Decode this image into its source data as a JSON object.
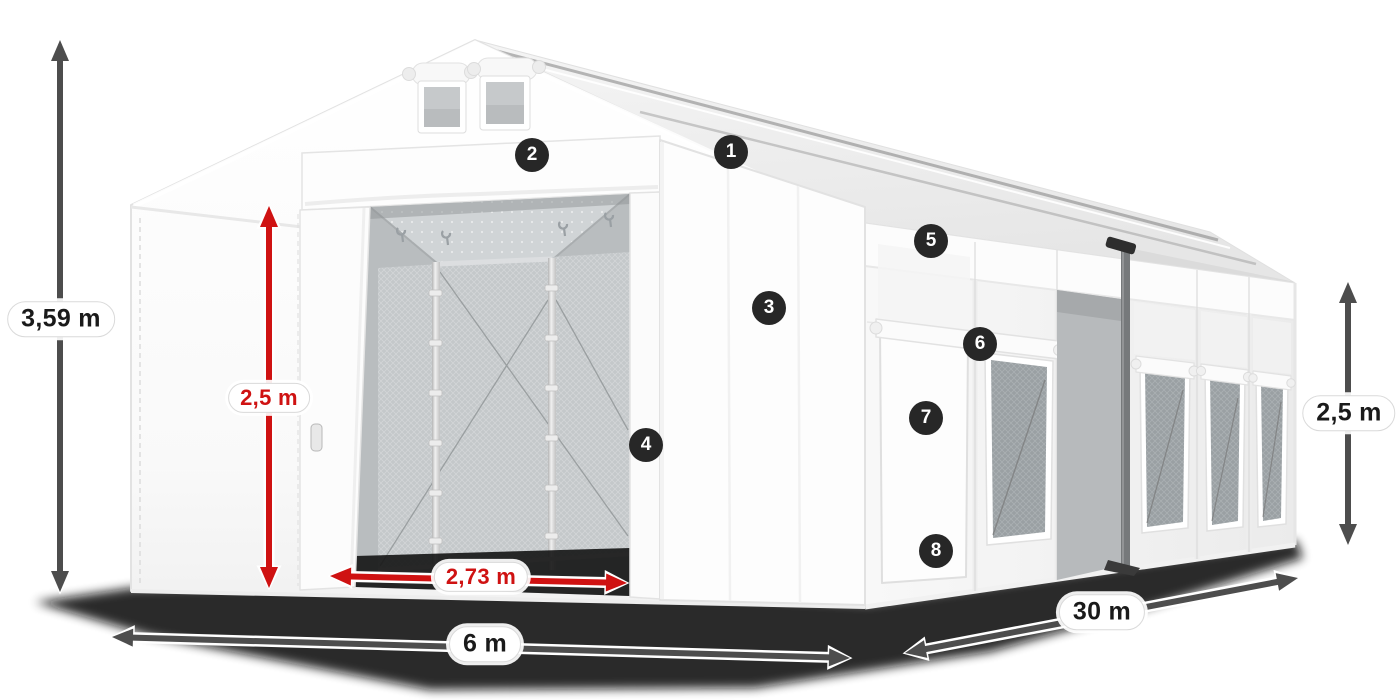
{
  "diagram": {
    "kind": "tent-dimension-diagram",
    "colors": {
      "background": "#ffffff",
      "red": "#cf1212",
      "dark": "#4d4d4d",
      "badge_bg": "#272727",
      "badge_text": "#ffffff",
      "label_text": "#1a1a1a"
    },
    "callouts": [
      {
        "label": "1",
        "x": 731,
        "y": 152
      },
      {
        "label": "2",
        "x": 532,
        "y": 155
      },
      {
        "label": "3",
        "x": 769,
        "y": 308
      },
      {
        "label": "4",
        "x": 646,
        "y": 445
      },
      {
        "label": "5",
        "x": 931,
        "y": 241
      },
      {
        "label": "6",
        "x": 980,
        "y": 344
      },
      {
        "label": "7",
        "x": 926,
        "y": 418
      },
      {
        "label": "8",
        "x": 936,
        "y": 551
      }
    ],
    "dimensions": [
      {
        "name": "total-height",
        "text": "3,59 m",
        "style": "dark",
        "x1": 60,
        "y1": 40,
        "x2": 60,
        "y2": 592,
        "label_x": 61,
        "label_y": 319
      },
      {
        "name": "entrance-height",
        "text": "2,5 m",
        "style": "red",
        "x1": 269,
        "y1": 206,
        "x2": 269,
        "y2": 588,
        "label_x": 269,
        "label_y": 398
      },
      {
        "name": "entrance-width",
        "text": "2,73 m",
        "style": "red",
        "x1": 330,
        "y1": 576,
        "x2": 627,
        "y2": 583,
        "label_x": 481,
        "label_y": 577
      },
      {
        "name": "front-width",
        "text": "6 m",
        "style": "dark",
        "x1": 112,
        "y1": 637,
        "x2": 850,
        "y2": 658,
        "label_x": 485,
        "label_y": 644
      },
      {
        "name": "side-length",
        "text": "30 m",
        "style": "dark",
        "x1": 905,
        "y1": 653,
        "x2": 1298,
        "y2": 578,
        "label_x": 1102,
        "label_y": 612
      },
      {
        "name": "side-wall-height",
        "text": "2,5 m",
        "style": "dark",
        "x1": 1348,
        "y1": 282,
        "x2": 1348,
        "y2": 545,
        "label_x": 1349,
        "label_y": 413
      }
    ]
  }
}
